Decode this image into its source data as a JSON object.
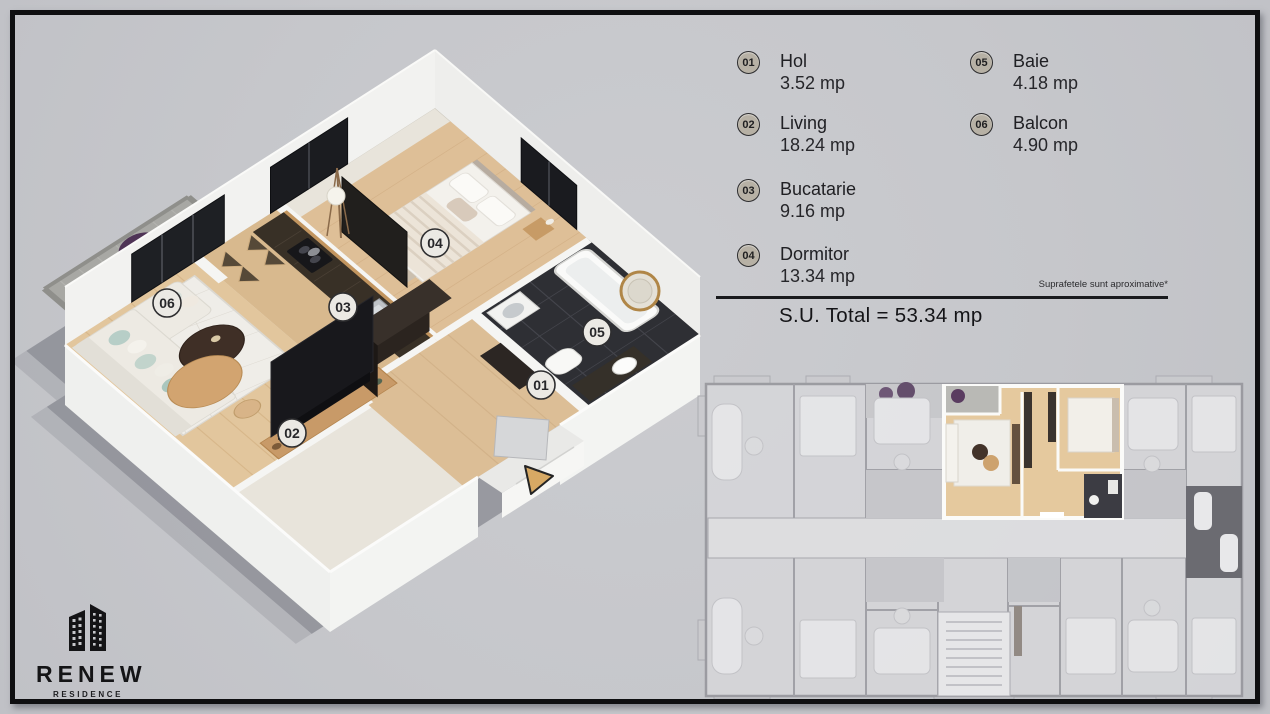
{
  "colors": {
    "background": "#c6c7cb",
    "frame": "#0f0f11",
    "wood_floor": "#debf97",
    "highlight_wood": "#e5c99e",
    "legend_badge": "#b7b1a5",
    "plan_badge": "#ebe9e4",
    "entrance_arrow": "#d7a964"
  },
  "legend": {
    "items": [
      {
        "num": "01",
        "name": "Hol",
        "area": "3.52 mp"
      },
      {
        "num": "02",
        "name": "Living",
        "area": "18.24 mp"
      },
      {
        "num": "03",
        "name": "Bucatarie",
        "area": "9.16 mp"
      },
      {
        "num": "04",
        "name": "Dormitor",
        "area": "13.34 mp"
      },
      {
        "num": "05",
        "name": "Baie",
        "area": "4.18 mp"
      },
      {
        "num": "06",
        "name": "Balcon",
        "area": "4.90 mp"
      }
    ],
    "disclaimer": "Suprafetele sunt aproximative*",
    "total": "S.U. Total = 53.34 mp"
  },
  "logo": {
    "name": "RENEW",
    "subtitle": "RESIDENCE"
  }
}
